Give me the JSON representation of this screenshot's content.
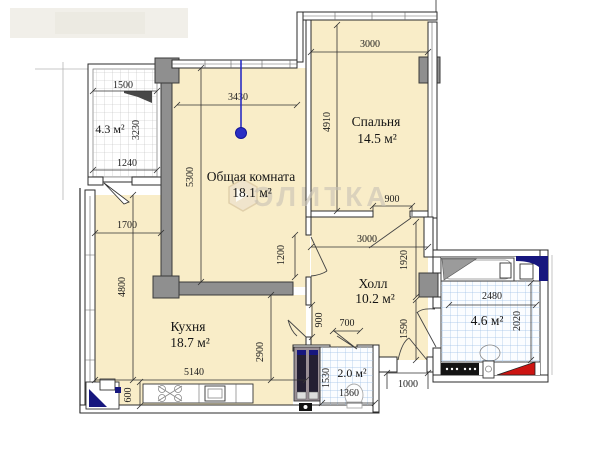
{
  "watermark": {
    "brand": "ЭЛИТКА"
  },
  "rooms": {
    "living": {
      "name": "Общая комната",
      "area": "18.1 м²"
    },
    "bedroom": {
      "name": "Спальня",
      "area": "14.5 м²"
    },
    "kitchen": {
      "name": "Кухня",
      "area": "18.7 м²"
    },
    "hall": {
      "name": "Холл",
      "area": "10.2 м²"
    },
    "balcony": {
      "area": "4.3 м²"
    },
    "bathroom": {
      "area": "4.6 м²"
    },
    "wc": {
      "area": "2.0 м²"
    }
  },
  "dims": {
    "balcony_width_top": "1500",
    "balcony_depth": "3230",
    "balcony_width_bottom": "1240",
    "living_width": "3430",
    "living_depth": "5300",
    "living_door": "1200",
    "bedroom_width": "3000",
    "bedroom_depth": "4910",
    "bedroom_door": "900",
    "hall_width": "3000",
    "hall_depth_upper": "1920",
    "hall_depth_lower": "1590",
    "kitchen_nook_width": "1700",
    "kitchen_depth": "4800",
    "kitchen_width": "5140",
    "kitchen_right_depth": "2900",
    "kitchen_door": "900",
    "counter_depth": "600",
    "wc_door": "700",
    "wc_depth": "1530",
    "wc_width": "1360",
    "entry_door": "1000",
    "bath_width": "2480",
    "bath_depth": "2020"
  },
  "colors": {
    "floor": "#f9edc8",
    "wall_gray": "#8f8f8f",
    "tile_blue": "#9fc1e6",
    "accent_red": "#cc1412",
    "accent_navy": "#16167e",
    "marker_blue": "#2a2ec4"
  }
}
